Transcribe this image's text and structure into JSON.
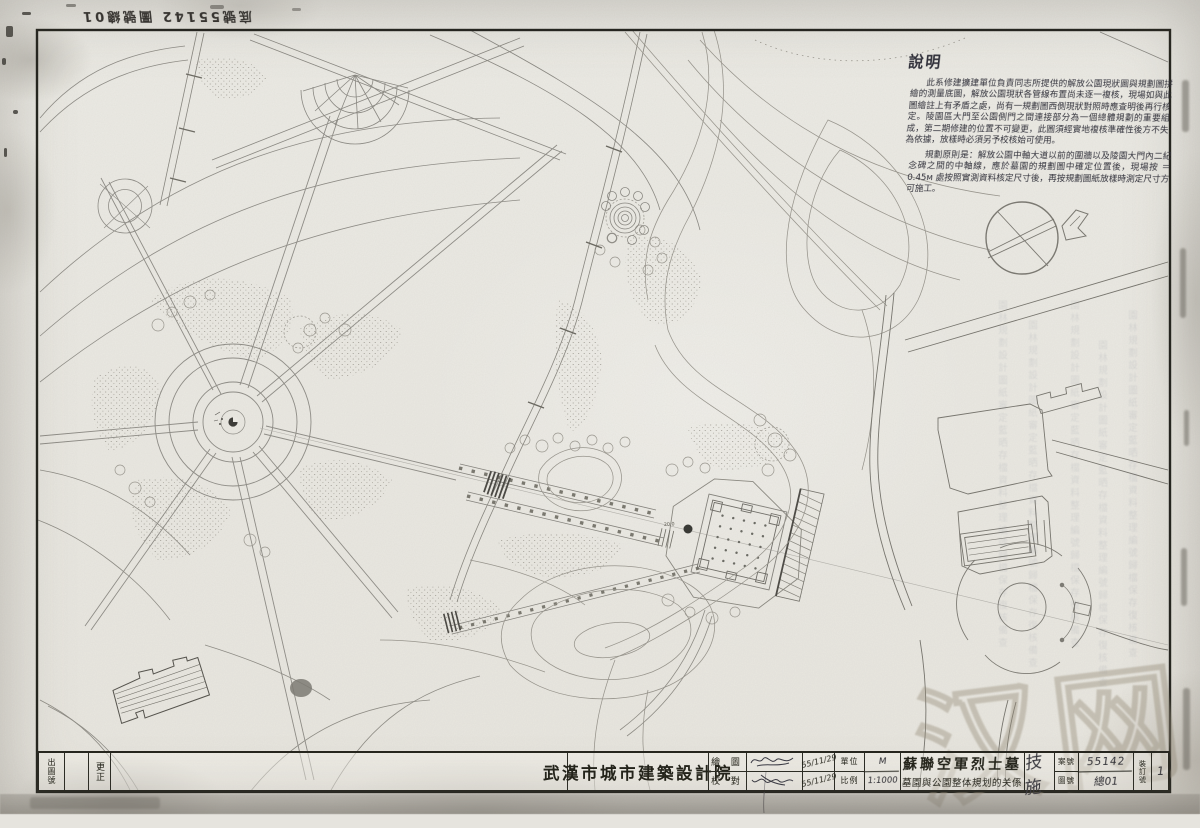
{
  "sheet": {
    "archive_note": "底號55142 圖號總01",
    "notes": {
      "heading": "說明",
      "p1": "此系修建擴建單位負責同志所提供的解放公園現狀圖與規劃圖拼繪的測量底圖，解放公園現狀各管線布置尚未逐一複核，現場如與此圖繪註上有矛盾之處，尚有一規劃圖西側現狀對照時應查明後再行核定。陵園區大門至公園側門之間連接部分為一個總體規劃的重要組成，第二期修建的位置不可變更，此圖須經實地複核準確性後方不失為依據，放樣時必須另予校核始可使用。",
      "p2": "規劃原則是：解放公園中軸大道以前的圍牆以及陵園大門內二紀念碑之間的中軸線，應於墓園的規劃圖中確定位置後，現場按 ＝0.45м 處按照實測資料核定尺寸後，再按規劃圖紙放樣時測定尺寸方可施工。"
    },
    "bleed_text": "園林規劃設計圖紙審定藍晒存檔資料整理編號歸檔保存復核備查",
    "watermark": "汉网",
    "map": {
      "elevation_note": "20.0"
    },
    "title_block": {
      "issue_no_label": "出圖號",
      "correction_label": "更正",
      "institute": "武漢市城市建築設計院",
      "drawn_label": "繪 圖",
      "checked_label": "校 對",
      "drawn_date": "55/11/29",
      "checked_date": "55/11/29",
      "unit_label": "單位",
      "unit_value": "M",
      "scale_label": "比例",
      "scale_value": "1:1000",
      "project_title": "蘇聯空軍烈士墓",
      "project_subtitle": "墓園與公園整体規划的关係",
      "phase": "技施",
      "case_no_label": "案號",
      "case_no": "55142",
      "drawing_no_label": "圖號",
      "drawing_no": "總01",
      "binding_no_label": "裝訂號",
      "binding_no": "1"
    }
  }
}
